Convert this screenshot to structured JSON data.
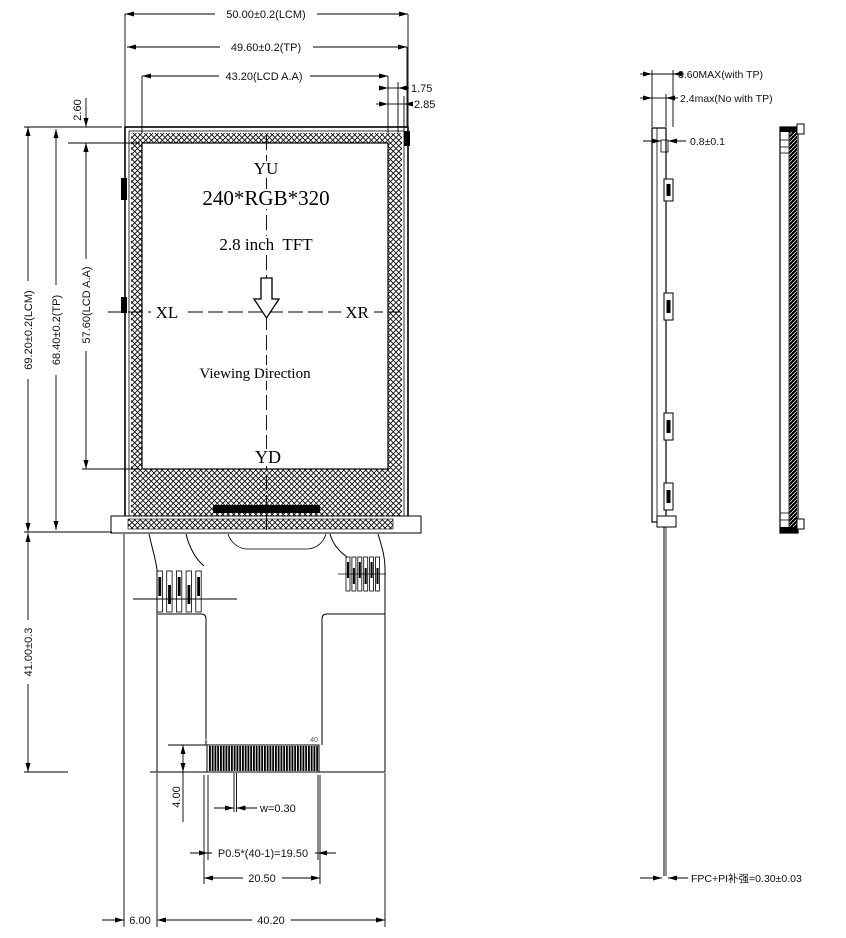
{
  "front": {
    "screen": {
      "yu": "YU",
      "res": "240*RGB*320",
      "size": "2.8 inch  TFT",
      "xl": "XL",
      "xr": "XR",
      "viewing": "Viewing Direction",
      "yd": "YD"
    },
    "dims": {
      "lcm_w": "50.00±0.2(LCM)",
      "tp_w": "49.60±0.2(TP)",
      "aa_w": "43.20(LCD A.A)",
      "gap1": "1.75",
      "gap2": "2.85",
      "top_m": "2.60",
      "lcm_h": "69.20±0.2(LCM)",
      "tp_h": "68.40±0.2(TP)",
      "aa_h": "57.60(LCD A.A)",
      "fpc_len": "41.00±0.3",
      "conn_h": "4.00",
      "finger_w": "w=0.30",
      "pitch": "P0.5*(40-1)=19.50",
      "conn_w": "20.50",
      "off": "6.00",
      "fpc_w": "40.20",
      "pin1": "1",
      "pin40": "40"
    }
  },
  "side": {
    "dims": {
      "with_tp": "3.60MAX(with TP)",
      "no_tp": "2.4max(No with TP)",
      "step": "0.8±0.1",
      "fpc": "FPC+PI补强=0.30±0.03"
    }
  }
}
